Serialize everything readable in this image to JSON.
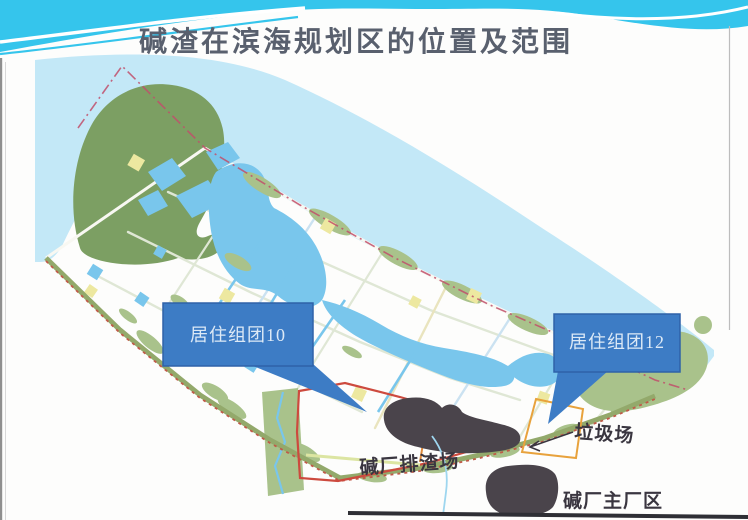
{
  "slide": {
    "title": "碱渣在滨海规划区的位置及范围"
  },
  "map": {
    "callout_cluster10": "居住组团10",
    "callout_cluster12": "居住组团12",
    "label_slag_site": "碱厂排渣场",
    "label_garbage_dump": "垃圾场",
    "label_main_plant": "碱厂主厂区"
  },
  "colors": {
    "ribbon_cyan": "#35C5EC",
    "sea": "#C3E8F7",
    "hill_green": "#7C9F63",
    "patch_green": "#A9C28B",
    "canal_blue": "#79C6EC",
    "yellow_patch": "#EDE8A0",
    "boundary_red": "#CD4A3E",
    "dashdot_red": "#C14F6B",
    "callout_blue": "#3D7CC5",
    "callout_border": "#2E62A8",
    "slag_dark": "#4A444B",
    "title_text": "#59606E",
    "map_label": "#3A3640",
    "shore_green": "#93A96B"
  }
}
